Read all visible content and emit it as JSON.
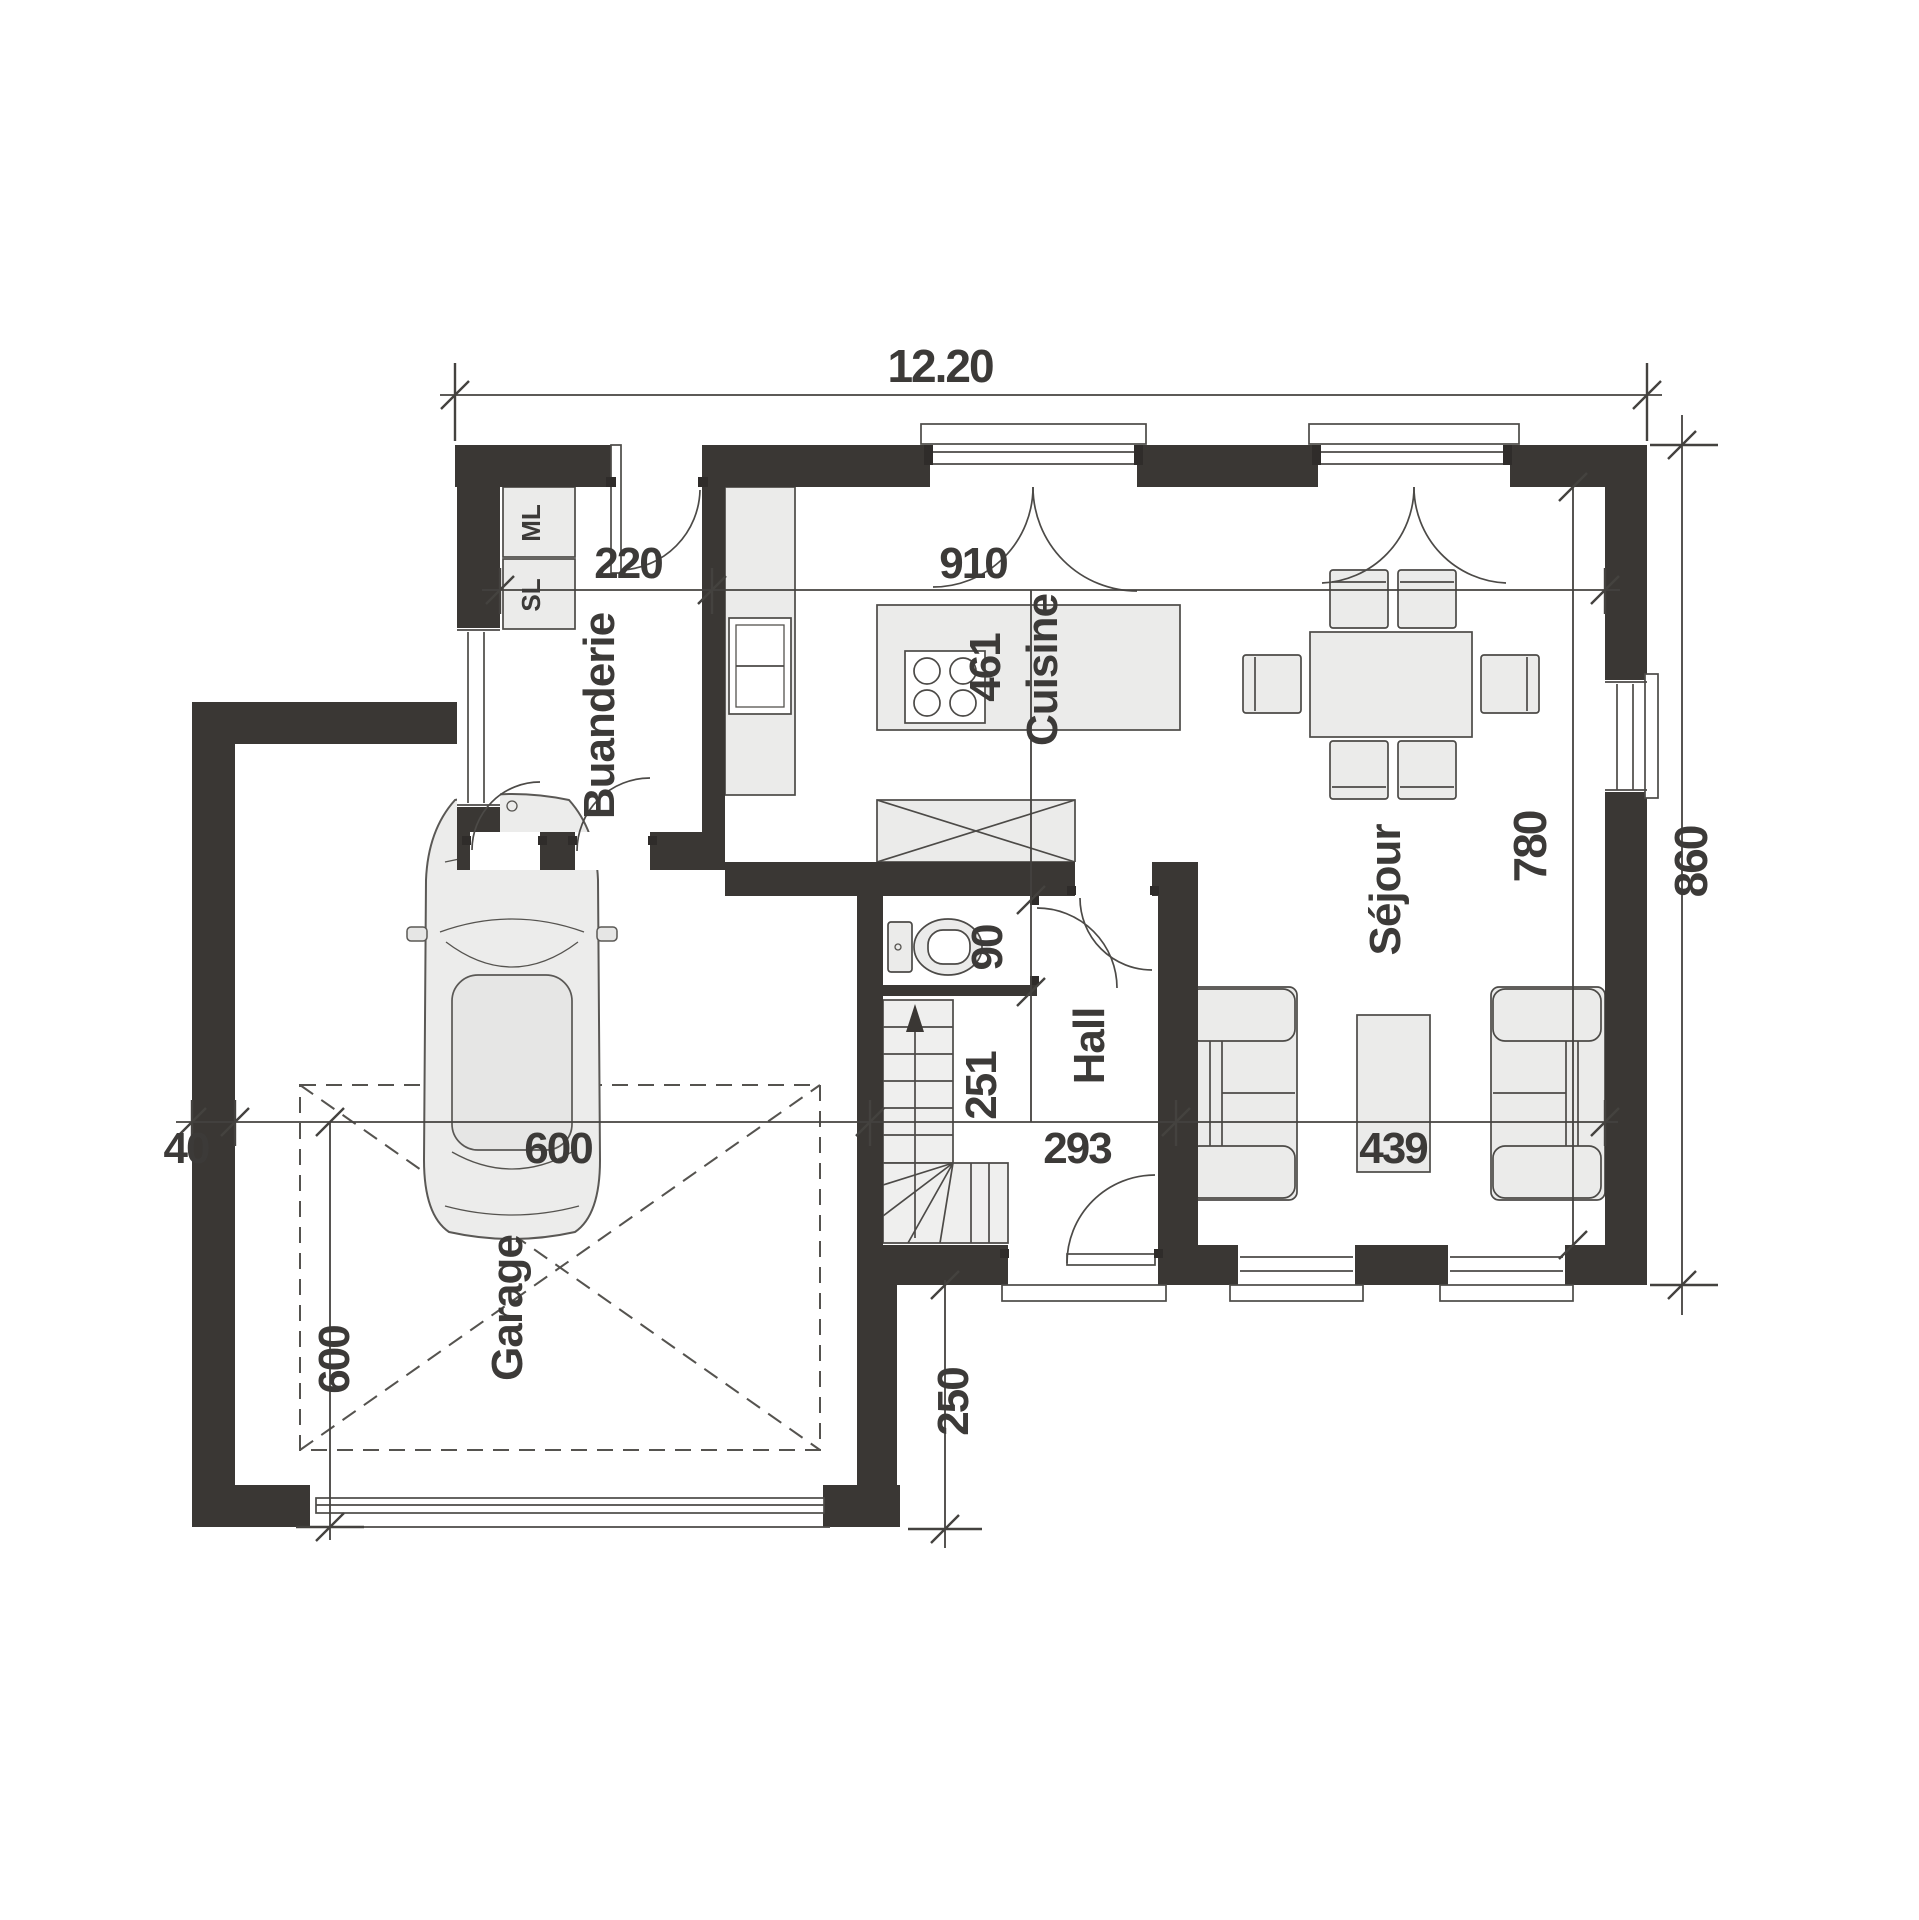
{
  "plan": {
    "rooms": {
      "buanderie": "Buanderie",
      "cuisine": "Cuisine",
      "sejour": "Séjour",
      "hall": "Hall",
      "garage": "Garage"
    },
    "appliances": {
      "washer": "ML",
      "dryer": "SL"
    },
    "dimensions": {
      "overall_width_m": "12.20",
      "overall_depth": "860",
      "buanderie_width": "220",
      "living_width": "910",
      "island_length": "461",
      "sejour_depth": "780",
      "wc_depth": "90",
      "hall_depth": "251",
      "hall_width": "293",
      "sejour_bottom_width": "439",
      "garage_bay_width": "600",
      "garage_bay_depth": "600",
      "wall_offset": "40",
      "porch_depth": "250"
    },
    "colors": {
      "wall": "#3a3734",
      "line": "#4c4a47",
      "furniture": "#ebebea",
      "text": "#3c3a38"
    }
  }
}
